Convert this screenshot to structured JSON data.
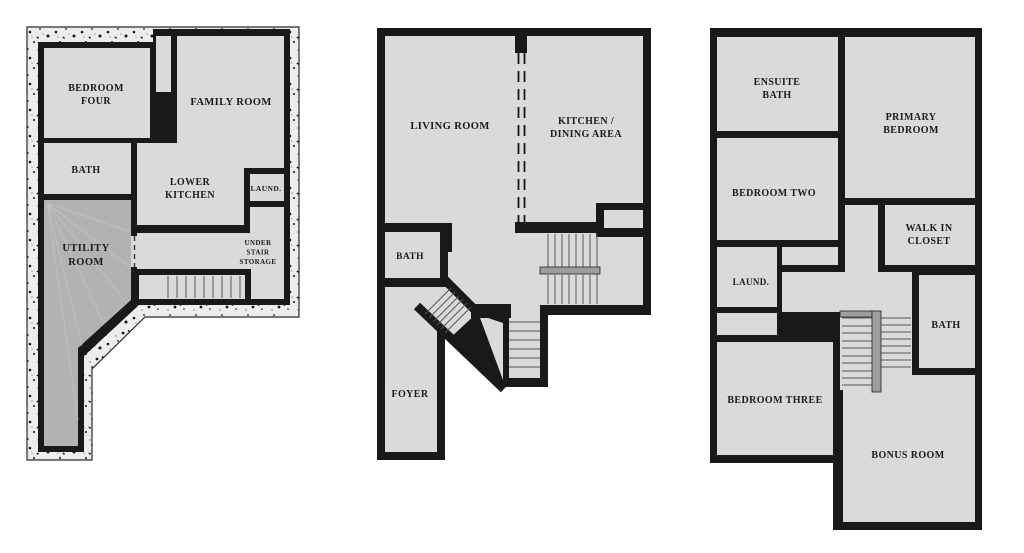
{
  "document": {
    "kind": "three-level floor plan sheet"
  },
  "colors": {
    "wall": "#191919",
    "room": "#dadada",
    "utility": "#b2b2b2",
    "rail": "#9d9d9d",
    "foundation": "#ededed"
  },
  "floors": [
    {
      "id": "basement",
      "rooms": [
        {
          "name": "bedroom-four",
          "lines": [
            "BEDROOM",
            "FOUR"
          ],
          "x": 96,
          "y": 91,
          "size": 10,
          "dy": 13
        },
        {
          "name": "family-room",
          "lines": [
            "FAMILY ROOM"
          ],
          "x": 231,
          "y": 105,
          "size": 10.5,
          "dy": 13
        },
        {
          "name": "bath",
          "lines": [
            "BATH"
          ],
          "x": 86,
          "y": 173,
          "size": 10,
          "dy": 13
        },
        {
          "name": "lower-kitchen",
          "lines": [
            "LOWER",
            "KITCHEN"
          ],
          "x": 190,
          "y": 185,
          "size": 10,
          "dy": 13
        },
        {
          "name": "laundry",
          "lines": [
            "LAUND."
          ],
          "x": 266,
          "y": 191,
          "size": 7.5,
          "dy": 10
        },
        {
          "name": "under-stair-storage",
          "lines": [
            "UNDER",
            "STAIR",
            "STORAGE"
          ],
          "x": 258,
          "y": 245,
          "size": 7,
          "dy": 9.5
        },
        {
          "name": "utility-room",
          "lines": [
            "UTILITY",
            "ROOM"
          ],
          "x": 86,
          "y": 251,
          "size": 10.5,
          "dy": 14
        }
      ]
    },
    {
      "id": "main",
      "rooms": [
        {
          "name": "living-room",
          "lines": [
            "LIVING ROOM"
          ],
          "x": 450,
          "y": 129,
          "size": 10.5,
          "dy": 13
        },
        {
          "name": "kitchen-dining-area",
          "lines": [
            "KITCHEN /",
            "DINING AREA"
          ],
          "x": 586,
          "y": 124,
          "size": 10,
          "dy": 13
        },
        {
          "name": "bath",
          "lines": [
            "BATH"
          ],
          "x": 410,
          "y": 259,
          "size": 9.5,
          "dy": 13
        },
        {
          "name": "foyer",
          "lines": [
            "FOYER"
          ],
          "x": 410,
          "y": 397,
          "size": 10,
          "dy": 13
        }
      ]
    },
    {
      "id": "upper",
      "rooms": [
        {
          "name": "ensuite-bath",
          "lines": [
            "ENSUITE",
            "BATH"
          ],
          "x": 777,
          "y": 85,
          "size": 10,
          "dy": 13
        },
        {
          "name": "primary-bedroom",
          "lines": [
            "PRIMARY",
            "BEDROOM"
          ],
          "x": 911,
          "y": 120,
          "size": 10,
          "dy": 13
        },
        {
          "name": "bedroom-two",
          "lines": [
            "BEDROOM TWO"
          ],
          "x": 774,
          "y": 196,
          "size": 10,
          "dy": 13
        },
        {
          "name": "walk-in-closet",
          "lines": [
            "WALK IN",
            "CLOSET"
          ],
          "x": 929,
          "y": 231,
          "size": 10,
          "dy": 13
        },
        {
          "name": "laundry",
          "lines": [
            "LAUND."
          ],
          "x": 751,
          "y": 285,
          "size": 9,
          "dy": 11
        },
        {
          "name": "bath",
          "lines": [
            "BATH"
          ],
          "x": 946,
          "y": 328,
          "size": 10,
          "dy": 13
        },
        {
          "name": "bedroom-three",
          "lines": [
            "BEDROOM THREE"
          ],
          "x": 775,
          "y": 403,
          "size": 10,
          "dy": 13
        },
        {
          "name": "bonus-room",
          "lines": [
            "BONUS ROOM"
          ],
          "x": 908,
          "y": 458,
          "size": 10,
          "dy": 13
        }
      ]
    }
  ]
}
